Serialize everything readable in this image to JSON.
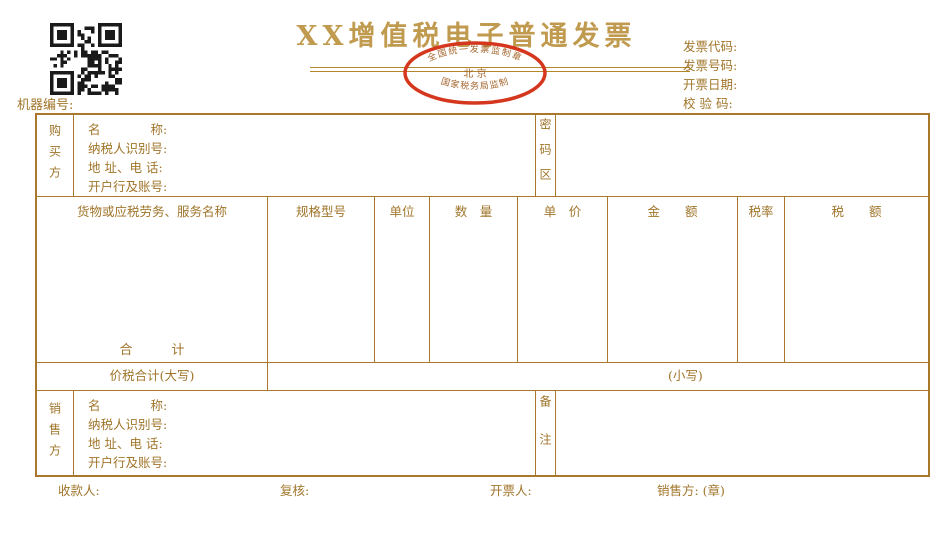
{
  "title": "XX增值税电子普通发票",
  "machine_no_label": "机器编号:",
  "header_fields": {
    "code": "发票代码:",
    "number": "发票号码:",
    "date": "开票日期:",
    "checksum": "校 验 码:"
  },
  "seal": {
    "top_text": "全国统一发票监制章",
    "center_text": "北 京",
    "bottom_text": "国家税务局监制"
  },
  "buyer": {
    "side_label": "购买方",
    "fields": [
      "名　　　　称:",
      "纳税人识别号:",
      "地 址、电 话:",
      "开户行及账号:"
    ],
    "password_label": "密码区"
  },
  "goods": {
    "columns": [
      "货物或应税劳务、服务名称",
      "规格型号",
      "单位",
      "数　量",
      "单　价",
      "金　　额",
      "税率",
      "税　　额"
    ],
    "total_label": "合　　　计"
  },
  "totals": {
    "words_label": "价税合计(大写)",
    "figures_label": "(小写)"
  },
  "seller": {
    "side_label": "销售方",
    "fields": [
      "名　　　　称:",
      "纳税人识别号:",
      "地 址、电 话:",
      "开户行及账号:"
    ],
    "remarks_label": "备注"
  },
  "footer": {
    "payee_label": "收款人:",
    "reviewer_label": "复核:",
    "issuer_label": "开票人:",
    "seller_seal_label": "销售方: (章)"
  },
  "colors": {
    "line": "#a9782c",
    "text": "#a0752a",
    "title_gold": "#c09a4e",
    "seal_red": "#d4371d",
    "qr_black": "#1a1a1a"
  }
}
